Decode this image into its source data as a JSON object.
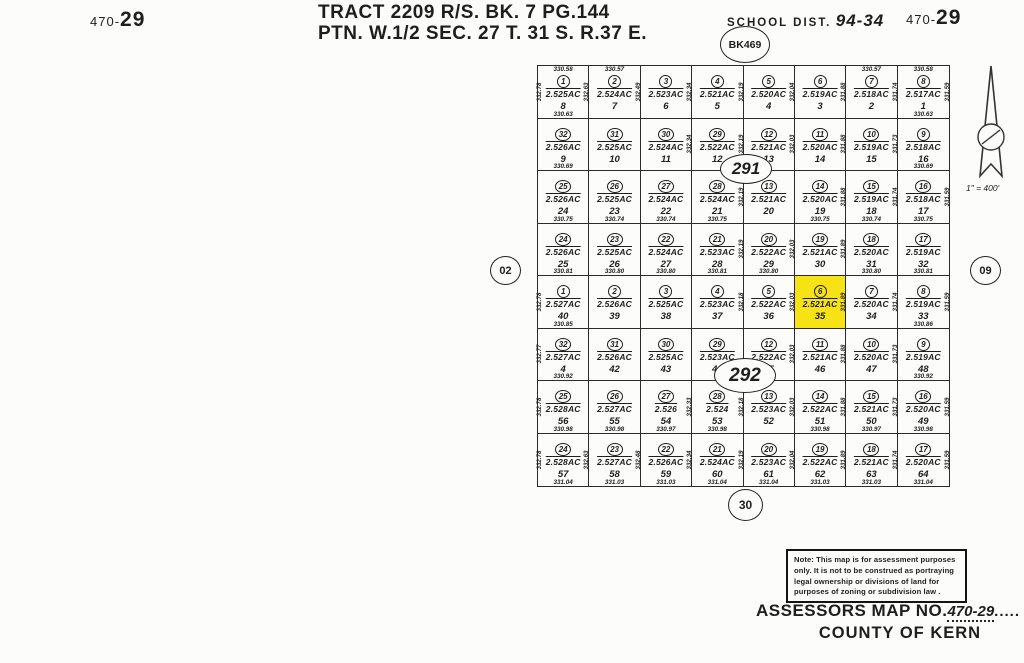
{
  "page": {
    "sheet_no_left": {
      "prefix": "470-",
      "num": "29"
    },
    "sheet_no_right": {
      "prefix": "470-",
      "num": "29"
    },
    "title_line1": "TRACT 2209 R/S. BK. 7 PG.144",
    "title_line2": "PTN. W.1/2 SEC. 27 T. 31 S. R.37 E.",
    "school_dist_label": "SCHOOL DIST.",
    "school_dist_value": "94-34",
    "book_circle": "BK469",
    "left_page_circle": "02",
    "right_page_circle": "09",
    "bottom_page_circle": "30",
    "block_circle_top": "291",
    "block_circle_bottom": "292",
    "scale": "1\" = 400'",
    "highlight_color": "#f7e315",
    "ink_color": "#1e1e1e"
  },
  "note": {
    "lines": [
      "Note: This map is for assessment purposes",
      "only. It is not to be construed as portraying",
      "legal ownership or divisions of land for",
      "purposes of zoning or subdivision law ."
    ]
  },
  "footer": {
    "map_no_label": "ASSESSORS MAP NO.",
    "map_no_value": "470-29",
    "map_no_dots": ".....",
    "county": "COUNTY OF KERN"
  },
  "grid": {
    "rows": [
      {
        "cells": [
          {
            "c": "1",
            "ac": "2.525AC",
            "n": "8",
            "t": "330.58",
            "b": "330.63",
            "l": "332.78",
            "r": "332.63"
          },
          {
            "c": "2",
            "ac": "2.524AC",
            "n": "7",
            "t": "330.57",
            "r": "332.49"
          },
          {
            "c": "3",
            "ac": "2.523AC",
            "n": "6",
            "r": "332.34"
          },
          {
            "c": "4",
            "ac": "2.521AC",
            "n": "5",
            "r": "332.19"
          },
          {
            "c": "5",
            "ac": "2.520AC",
            "n": "4",
            "r": "332.04"
          },
          {
            "c": "6",
            "ac": "2.519AC",
            "n": "3",
            "r": "331.88"
          },
          {
            "c": "7",
            "ac": "2.518AC",
            "n": "2",
            "t": "330.57",
            "r": "331.74"
          },
          {
            "c": "8",
            "ac": "2.517AC",
            "n": "1",
            "t": "330.58",
            "b": "330.63",
            "r": "331.59"
          }
        ]
      },
      {
        "cells": [
          {
            "c": "32",
            "ac": "2.526AC",
            "n": "9",
            "b": "330.69"
          },
          {
            "c": "31",
            "ac": "2.525AC",
            "n": "10"
          },
          {
            "c": "30",
            "ac": "2.524AC",
            "n": "11",
            "r": "332.34"
          },
          {
            "c": "29",
            "ac": "2.522AC",
            "n": "12",
            "r": "332.19"
          },
          {
            "c": "12",
            "ac": "2.521AC",
            "n": "13",
            "r": "332.03"
          },
          {
            "c": "11",
            "ac": "2.520AC",
            "n": "14",
            "r": "331.88"
          },
          {
            "c": "10",
            "ac": "2.519AC",
            "n": "15",
            "r": "331.73"
          },
          {
            "c": "9",
            "ac": "2.518AC",
            "n": "16",
            "b": "330.69"
          }
        ]
      },
      {
        "cells": [
          {
            "c": "25",
            "ac": "2.526AC",
            "n": "24",
            "b": "330.75"
          },
          {
            "c": "26",
            "ac": "2.525AC",
            "n": "23",
            "b": "330.74"
          },
          {
            "c": "27",
            "ac": "2.524AC",
            "n": "22",
            "b": "330.74"
          },
          {
            "c": "28",
            "ac": "2.524AC",
            "n": "21",
            "b": "330.75",
            "r": "332.19"
          },
          {
            "c": "13",
            "ac": "2.521AC",
            "n": "20"
          },
          {
            "c": "14",
            "ac": "2.520AC",
            "n": "19",
            "b": "330.75",
            "r": "331.88"
          },
          {
            "c": "15",
            "ac": "2.519AC",
            "n": "18",
            "b": "330.74",
            "r": "331.74"
          },
          {
            "c": "16",
            "ac": "2.518AC",
            "n": "17",
            "b": "330.75",
            "r": "331.59"
          }
        ]
      },
      {
        "cells": [
          {
            "c": "24",
            "ac": "2.526AC",
            "n": "25",
            "b": "330.81"
          },
          {
            "c": "23",
            "ac": "2.525AC",
            "n": "26",
            "b": "330.80"
          },
          {
            "c": "22",
            "ac": "2.524AC",
            "n": "27",
            "b": "330.80"
          },
          {
            "c": "21",
            "ac": "2.523AC",
            "n": "28",
            "b": "330.81",
            "r": "332.19"
          },
          {
            "c": "20",
            "ac": "2.522AC",
            "n": "29",
            "b": "330.80",
            "r": "332.03"
          },
          {
            "c": "19",
            "ac": "2.521AC",
            "n": "30",
            "r": "331.89"
          },
          {
            "c": "18",
            "ac": "2.520AC",
            "n": "31",
            "b": "330.80"
          },
          {
            "c": "17",
            "ac": "2.519AC",
            "n": "32",
            "b": "330.81"
          }
        ]
      },
      {
        "cells": [
          {
            "c": "1",
            "ac": "2.527AC",
            "n": "40",
            "b": "330.85",
            "l": "332.78"
          },
          {
            "c": "2",
            "ac": "2.526AC",
            "n": "39"
          },
          {
            "c": "3",
            "ac": "2.525AC",
            "n": "38"
          },
          {
            "c": "4",
            "ac": "2.523AC",
            "n": "37",
            "r": "332.18"
          },
          {
            "c": "5",
            "ac": "2.522AC",
            "n": "36",
            "r": "332.03"
          },
          {
            "c": "6",
            "ac": "2.521AC",
            "n": "35",
            "r": "331.89",
            "hl": true
          },
          {
            "c": "7",
            "ac": "2.520AC",
            "n": "34",
            "r": "331.74"
          },
          {
            "c": "8",
            "ac": "2.519AC",
            "n": "33",
            "b": "330.86",
            "r": "331.59"
          }
        ]
      },
      {
        "cells": [
          {
            "c": "32",
            "ac": "2.527AC",
            "n": "4",
            "b": "330.92",
            "l": "332.77"
          },
          {
            "c": "31",
            "ac": "2.526AC",
            "n": "42"
          },
          {
            "c": "30",
            "ac": "2.525AC",
            "n": "43"
          },
          {
            "c": "29",
            "ac": "2.523AC",
            "n": "44"
          },
          {
            "c": "12",
            "ac": "2.522AC",
            "n": "45",
            "r": "332.03"
          },
          {
            "c": "11",
            "ac": "2.521AC",
            "n": "46",
            "r": "331.88"
          },
          {
            "c": "10",
            "ac": "2.520AC",
            "n": "47",
            "r": "331.73"
          },
          {
            "c": "9",
            "ac": "2.519AC",
            "n": "48",
            "b": "330.92"
          }
        ]
      },
      {
        "cells": [
          {
            "c": "25",
            "ac": "2.528AC",
            "n": "56",
            "b": "330.98",
            "l": "332.78"
          },
          {
            "c": "26",
            "ac": "2.527AC",
            "n": "55",
            "b": "330.98"
          },
          {
            "c": "27",
            "ac": "2.526",
            "n": "54",
            "b": "330.97",
            "r": "332.33"
          },
          {
            "c": "28",
            "ac": "2.524",
            "n": "53",
            "b": "330.98",
            "r": "332.18"
          },
          {
            "c": "13",
            "ac": "2.523AC",
            "n": "52",
            "r": "332.03"
          },
          {
            "c": "14",
            "ac": "2.522AC",
            "n": "51",
            "b": "330.98",
            "r": "331.88"
          },
          {
            "c": "15",
            "ac": "2.521AC",
            "n": "50",
            "b": "330.97",
            "r": "331.73"
          },
          {
            "c": "16",
            "ac": "2.520AC",
            "n": "49",
            "b": "330.98",
            "r": "331.59"
          }
        ]
      },
      {
        "cells": [
          {
            "c": "24",
            "ac": "2.528AC",
            "n": "57",
            "b": "331.04",
            "l": "332.78",
            "r": "332.63"
          },
          {
            "c": "23",
            "ac": "2.527AC",
            "n": "58",
            "b": "331.03",
            "r": "332.48"
          },
          {
            "c": "22",
            "ac": "2.526AC",
            "n": "59",
            "b": "331.03",
            "r": "332.34"
          },
          {
            "c": "21",
            "ac": "2.524AC",
            "n": "60",
            "b": "331.04",
            "r": "332.19"
          },
          {
            "c": "20",
            "ac": "2.523AC",
            "n": "61",
            "b": "331.04",
            "r": "332.04"
          },
          {
            "c": "19",
            "ac": "2.522AC",
            "n": "62",
            "b": "331.03",
            "r": "331.89"
          },
          {
            "c": "18",
            "ac": "2.521AC",
            "n": "63",
            "b": "331.03",
            "r": "331.74"
          },
          {
            "c": "17",
            "ac": "2.520AC",
            "n": "64",
            "b": "331.04",
            "r": "331.59"
          }
        ]
      }
    ]
  }
}
